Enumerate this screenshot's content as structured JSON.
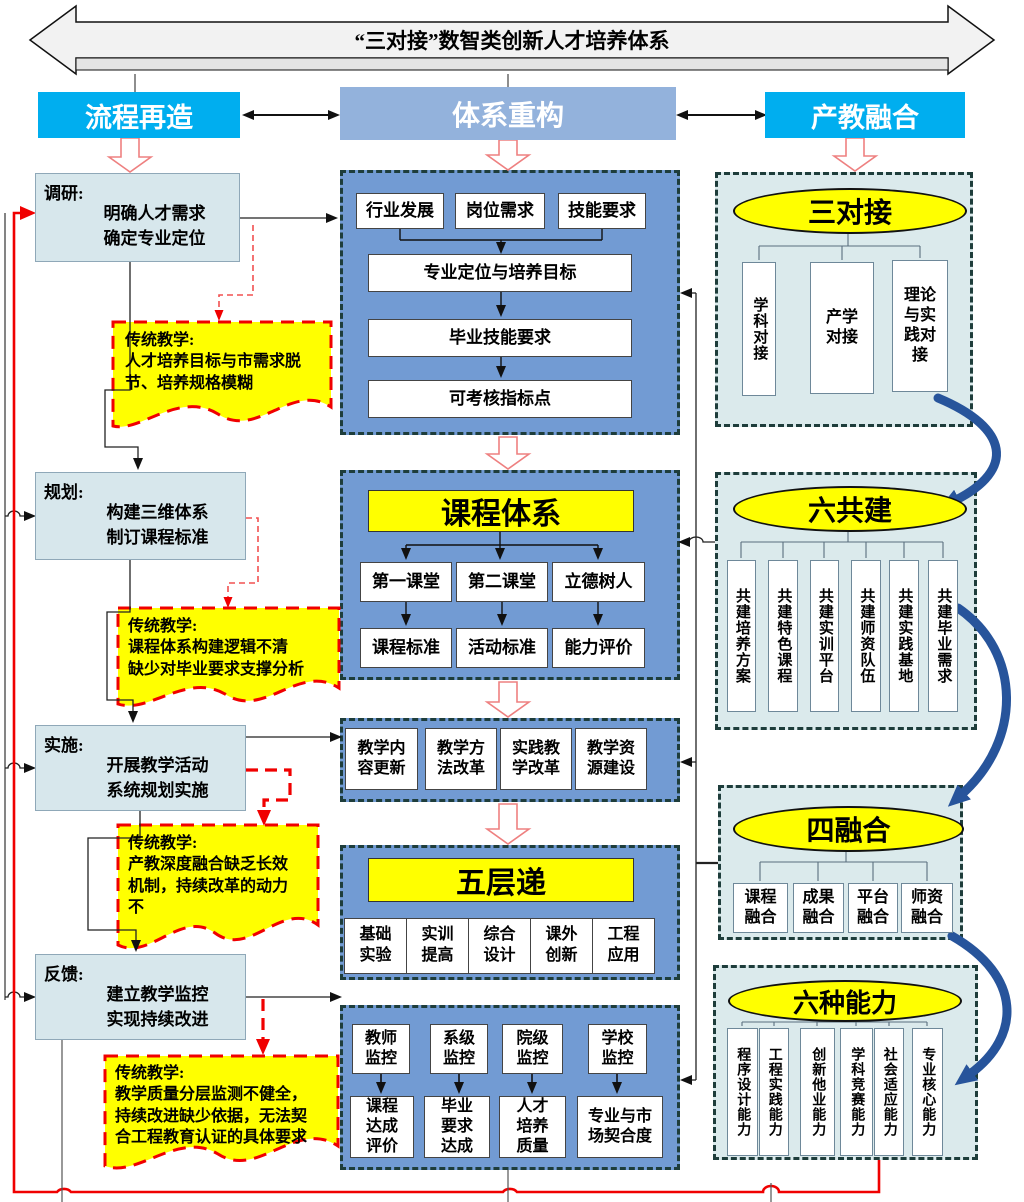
{
  "banner": {
    "title": "“三对接”数智类创新人才培养体系"
  },
  "headers": {
    "left": "流程再造",
    "center": "体系重构",
    "right": "产教融合"
  },
  "left_flow": {
    "steps": [
      {
        "label": "调研:",
        "line1": "明确人才需求",
        "line2": "确定专业定位"
      },
      {
        "label": "规划:",
        "line1": "构建三维体系",
        "line2": "制订课程标准"
      },
      {
        "label": "实施:",
        "line1": "开展教学活动",
        "line2": "系统规划实施"
      },
      {
        "label": "反馈:",
        "line1": "建立教学监控",
        "line2": "实现持续改进"
      }
    ],
    "notes": [
      {
        "title": "传统教学:",
        "lines": [
          "人才培养目标与市需求脱",
          "节、培养规格模糊"
        ]
      },
      {
        "title": "传统教学:",
        "lines": [
          "课程体系构建逻辑不清",
          "缺少对毕业要求支撑分析"
        ]
      },
      {
        "title": "传统教学:",
        "lines": [
          "产教深度融合缺乏长效",
          "机制，持续改革的动力",
          "不"
        ]
      },
      {
        "title": "传统教学:",
        "lines": [
          "教学质量分层监测不健全，",
          "持续改进缺少依据，无法契",
          "合工程教育认证的具体要求"
        ]
      }
    ]
  },
  "center": {
    "g1": {
      "row": [
        "行业发展",
        "岗位需求",
        "技能要求"
      ],
      "stack": [
        "专业定位与培养目标",
        "毕业技能要求",
        "可考核指标点"
      ]
    },
    "g2": {
      "title": "课程体系",
      "row1": [
        "第一课堂",
        "第二课堂",
        "立德树人"
      ],
      "row2": [
        "课程标准",
        "活动标准",
        "能力评价"
      ]
    },
    "g3": {
      "row": [
        "教学内容更新",
        "教学方法改革",
        "实践教学改革",
        "教学资源建设"
      ]
    },
    "g4": {
      "title": "五层递",
      "row": [
        "基础实验",
        "实训提高",
        "综合设计",
        "课外创新",
        "工程应用"
      ]
    },
    "g5": {
      "row1": [
        "教师监控",
        "系级监控",
        "院级监控",
        "学校监控"
      ],
      "row2": [
        "课程达成评价",
        "毕业要求达成",
        "人才培养质量",
        "专业与市场契合度"
      ]
    }
  },
  "right": {
    "g1": {
      "title": "三对接",
      "items": [
        "学科对接",
        "产学对接",
        "理论与实践对接"
      ]
    },
    "g2": {
      "title": "六共建",
      "items": [
        "共建培养方案",
        "共建特色课程",
        "共建实训平台",
        "共建师资队伍",
        "共建实践基地",
        "共建毕业需求"
      ]
    },
    "g3": {
      "title": "四融合",
      "items": [
        "课程融合",
        "成果融合",
        "平台融合",
        "师资融合"
      ]
    },
    "g4": {
      "title": "六种能力",
      "items": [
        "程序设计能力",
        "工程实践能力",
        "创新他业能力",
        "学科竞赛能力",
        "社会适应能力",
        "专业核心能力"
      ]
    }
  },
  "colors": {
    "header_cyan": "#00AEEF",
    "header_blue": "#93B2DC",
    "group_blue": "#729BD3",
    "panel_cyan": "#DBEAEC",
    "highlight_yellow": "#FFFF00",
    "alert_red": "#FF0000",
    "curve_blue": "#27549B",
    "dash_border": "#1E3D3B"
  }
}
